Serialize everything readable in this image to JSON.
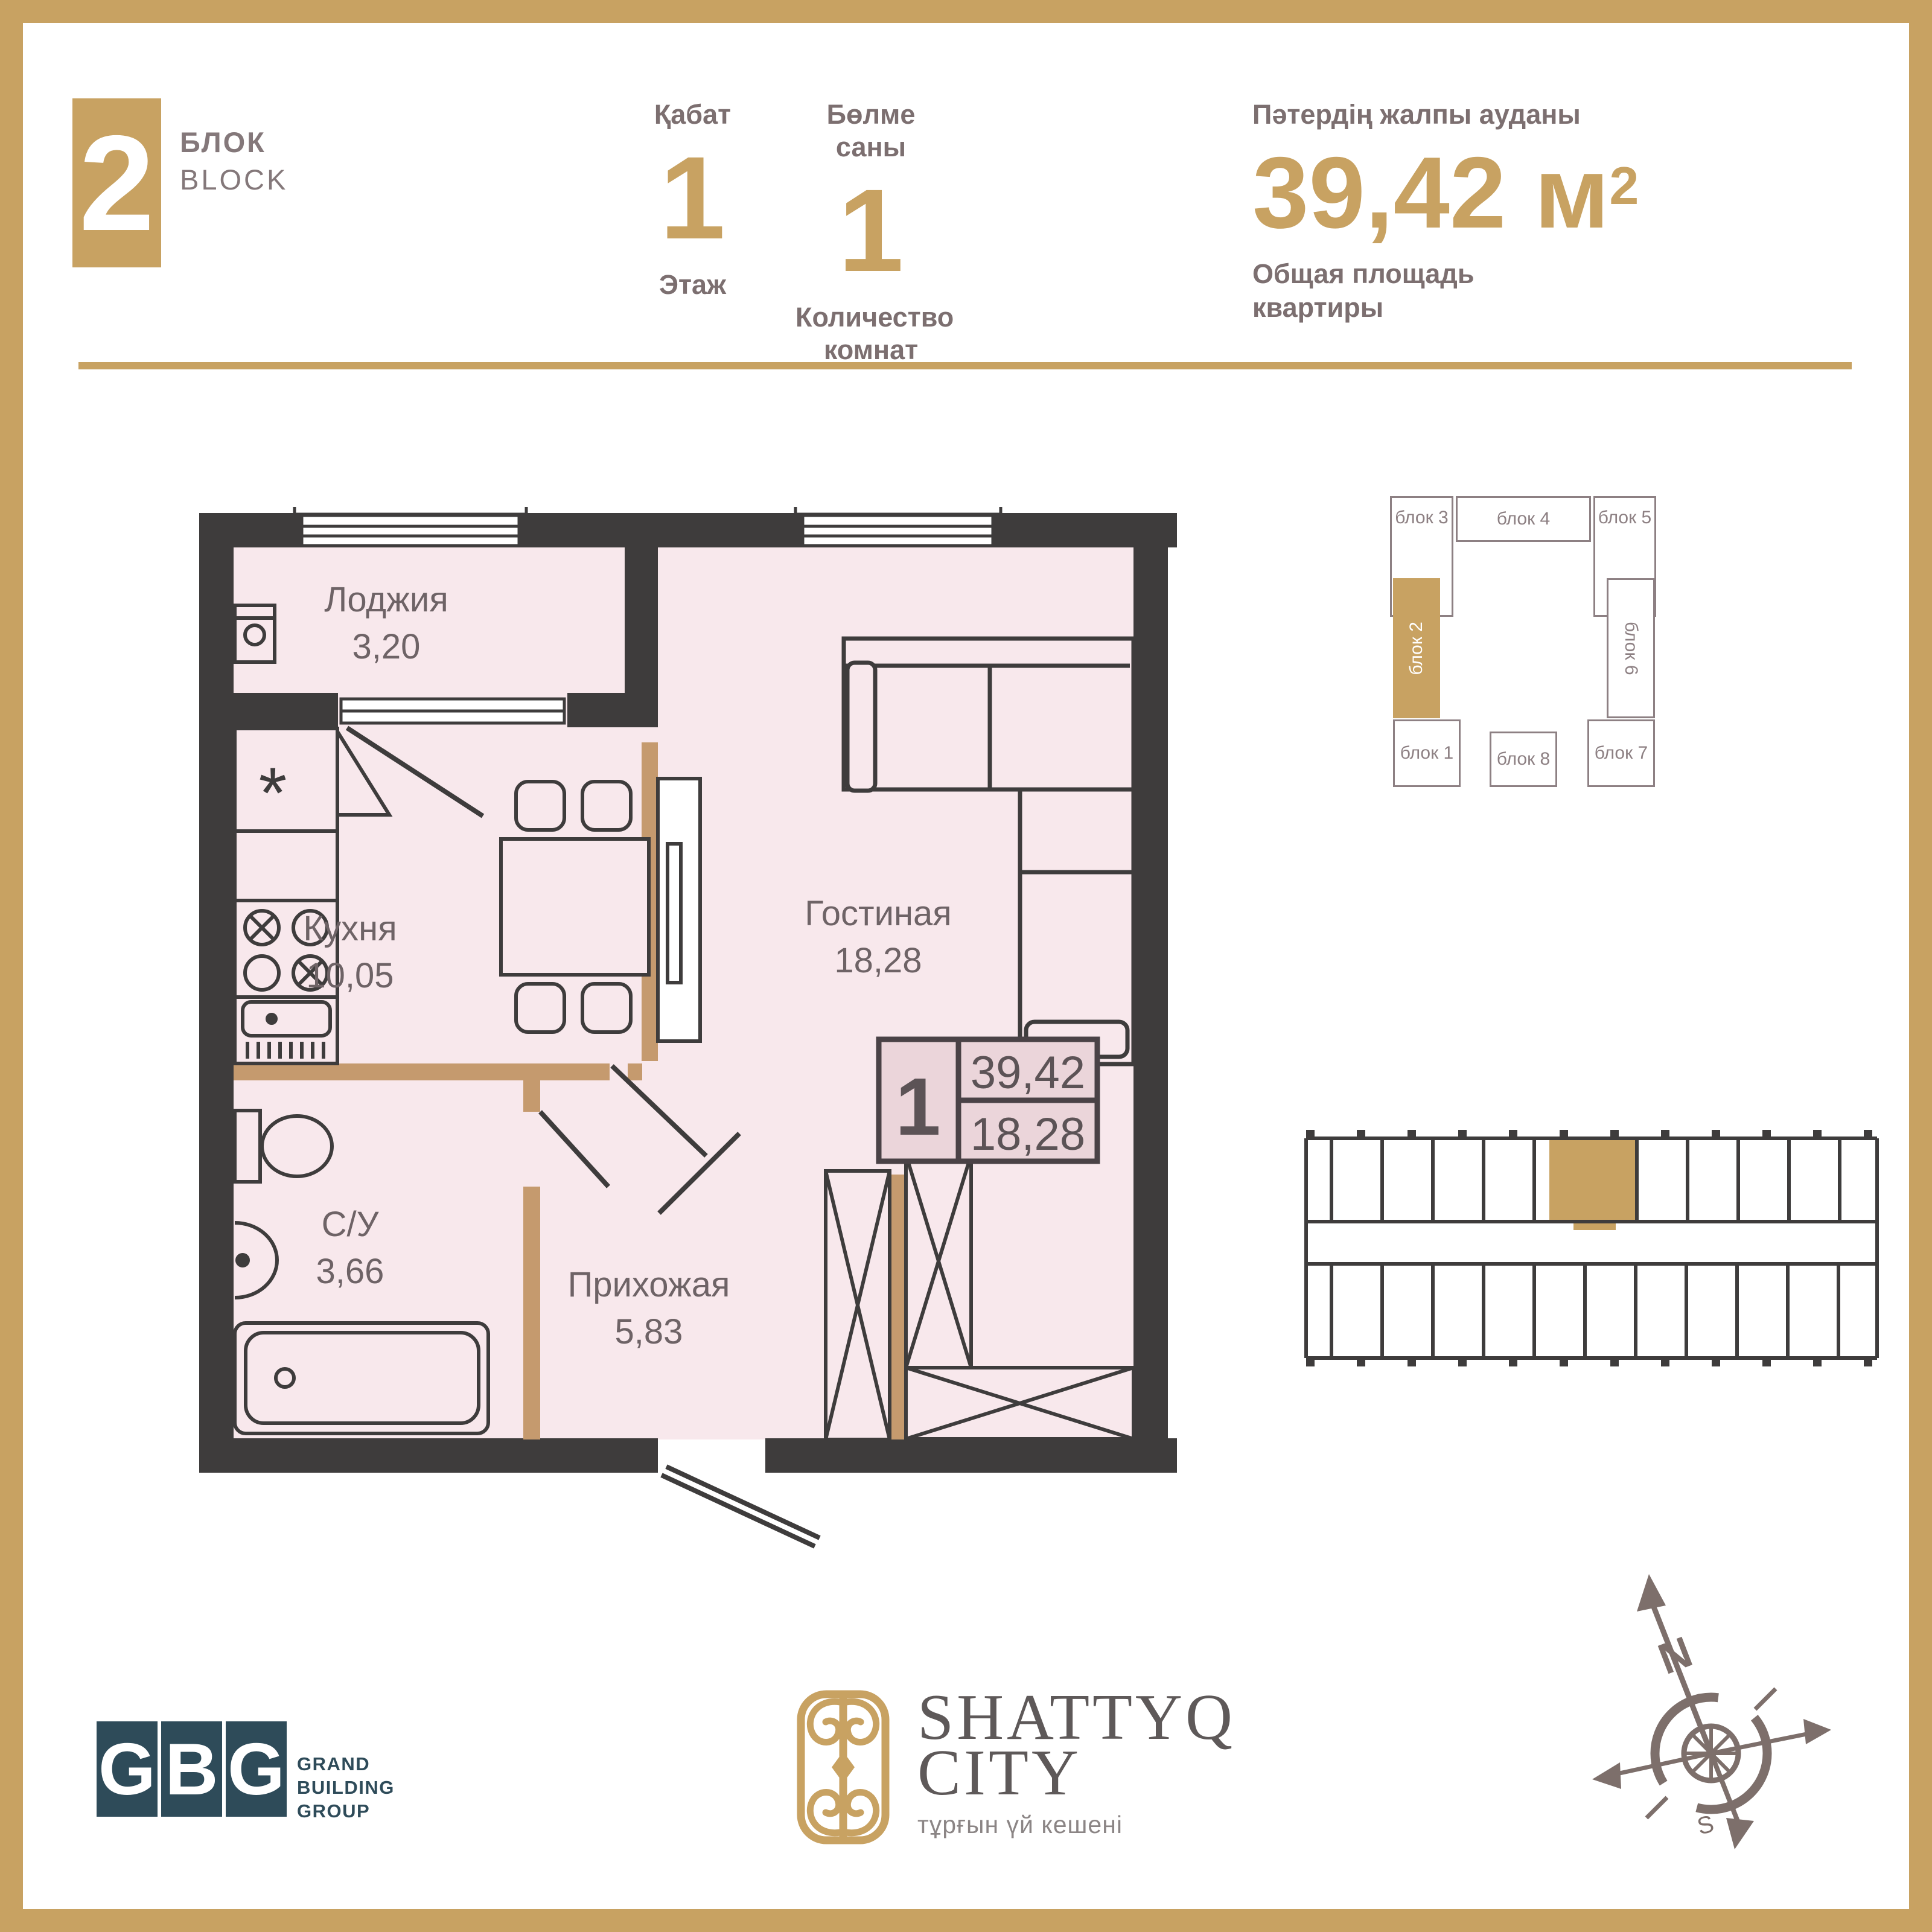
{
  "colors": {
    "accent_gold": "#C8A262",
    "wall_dark": "#3E3C3C",
    "room_pink": "#F8E8EC",
    "partition_tan": "#C59A6E",
    "stamp_fill": "#EBD5DA",
    "gbg_teal": "#2E4B59",
    "header_text": "#7C6F70",
    "plan_text": "#6E6366",
    "scheme_gray": "#8D8083",
    "compass_brown": "#7D6F6B"
  },
  "header": {
    "block_number": "2",
    "block_label_kk": "БЛОК",
    "block_label_en": "BLOCK",
    "floor": {
      "label_kk": "Қабат",
      "value": "1",
      "label_ru": "Этаж"
    },
    "rooms": {
      "label_kk": "Бөлме саны",
      "value": "1",
      "label_ru_line1": "Количество",
      "label_ru_line2": "комнат"
    },
    "area": {
      "label_kk": "Пәтердің жалпы ауданы",
      "value": "39,42",
      "unit": "м",
      "sup": "2",
      "label_ru_line1": "Общая площадь",
      "label_ru_line2": "квартиры"
    }
  },
  "plan": {
    "rooms": [
      {
        "name": "Лоджия",
        "area": "3,20"
      },
      {
        "name": "Кухня",
        "area": "10,05"
      },
      {
        "name": "Гостиная",
        "area": "18,28"
      },
      {
        "name": "С/У",
        "area": "3,66"
      },
      {
        "name": "Прихожая",
        "area": "5,83"
      }
    ],
    "fridge_symbol": "*",
    "stamp": {
      "rooms": "1",
      "total_area": "39,42",
      "living_area": "18,28"
    }
  },
  "block_scheme": {
    "blocks": [
      {
        "label": "блок 3"
      },
      {
        "label": "блок 4"
      },
      {
        "label": "блок 5"
      },
      {
        "label": "блок 2",
        "highlighted": true
      },
      {
        "label": "блок 6"
      },
      {
        "label": "блок 1"
      },
      {
        "label": "блок 8"
      },
      {
        "label": "блок 7"
      }
    ]
  },
  "compass": {
    "north_label": "N",
    "south_label": "S"
  },
  "footer": {
    "gbg": {
      "letters": [
        "G",
        "B",
        "G"
      ],
      "name_line1": "GRAND",
      "name_line2": "BUILDING",
      "name_line3": "GROUP"
    },
    "shattyq": {
      "title_line1": "SHATTYQ",
      "title_line2": "CITY",
      "subtitle": "тұрғын үй кешені"
    }
  }
}
